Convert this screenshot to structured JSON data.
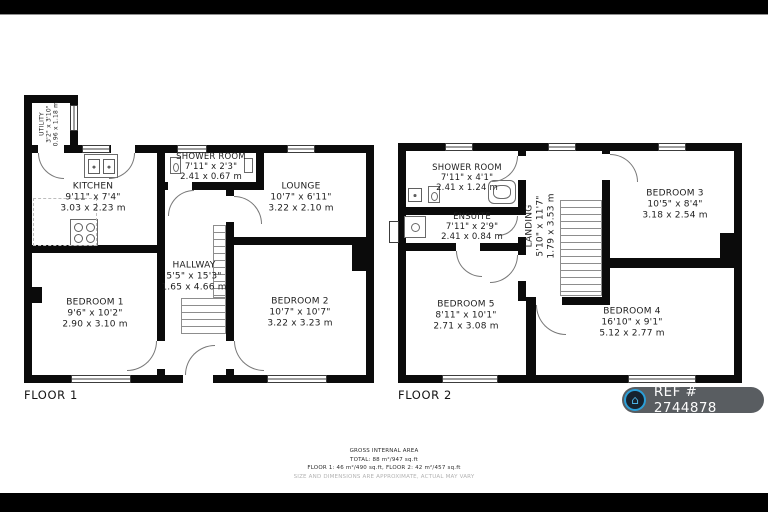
{
  "floor1": {
    "label": "FLOOR 1",
    "rooms": {
      "utility": {
        "name": "UTILITY",
        "imperial": "3'2\" x 3'10\"",
        "metric": "0.96 x 1.18 m"
      },
      "kitchen": {
        "name": "KITCHEN",
        "imperial": "9'11\" x 7'4\"",
        "metric": "3.03 x 2.23 m"
      },
      "shower_room": {
        "name": "SHOWER ROOM",
        "imperial": "7'11\" x 2'3\"",
        "metric": "2.41 x 0.67 m"
      },
      "lounge": {
        "name": "LOUNGE",
        "imperial": "10'7\" x 6'11\"",
        "metric": "3.22 x 2.10 m"
      },
      "hallway": {
        "name": "HALLWAY",
        "imperial": "5'5\" x 15'3\"",
        "metric": "1.65 x 4.66 m"
      },
      "bedroom1": {
        "name": "BEDROOM 1",
        "imperial": "9'6\" x 10'2\"",
        "metric": "2.90 x 3.10 m"
      },
      "bedroom2": {
        "name": "BEDROOM 2",
        "imperial": "10'7\" x 10'7\"",
        "metric": "3.22 x 3.23 m"
      }
    }
  },
  "floor2": {
    "label": "FLOOR 2",
    "rooms": {
      "shower_room": {
        "name": "SHOWER ROOM",
        "imperial": "7'11\" x 4'1\"",
        "metric": "2.41 x 1.24 m"
      },
      "ensuite": {
        "name": "ENSUITE",
        "imperial": "7'11\" x 2'9\"",
        "metric": "2.41 x 0.84 m"
      },
      "landing": {
        "name": "LANDING",
        "imperial": "5'10\" x 11'7\"",
        "metric": "1.79 x 3.53 m"
      },
      "bedroom3": {
        "name": "BEDROOM 3",
        "imperial": "10'5\" x 8'4\"",
        "metric": "3.18 x 2.54 m"
      },
      "bedroom4": {
        "name": "BEDROOM 4",
        "imperial": "16'10\" x 9'1\"",
        "metric": "5.12 x 2.77 m"
      },
      "bedroom5": {
        "name": "BEDROOM 5",
        "imperial": "8'11\" x 10'1\"",
        "metric": "2.71 x 3.08 m"
      }
    }
  },
  "footer": {
    "line1": "GROSS INTERNAL AREA",
    "line2": "TOTAL: 88 m²/947 sq.ft",
    "line3": "FLOOR 1: 46 m²/490 sq.ft, FLOOR 2: 42 m²/457 sq.ft",
    "line4": "SIZE AND DIMENSIONS ARE APPROXIMATE, ACTUAL MAY VARY"
  },
  "ref_badge": {
    "label": "REF # 2744878",
    "icon": "house-icon",
    "accent_color": "#2b9fd8",
    "background_color": "#595d61"
  }
}
